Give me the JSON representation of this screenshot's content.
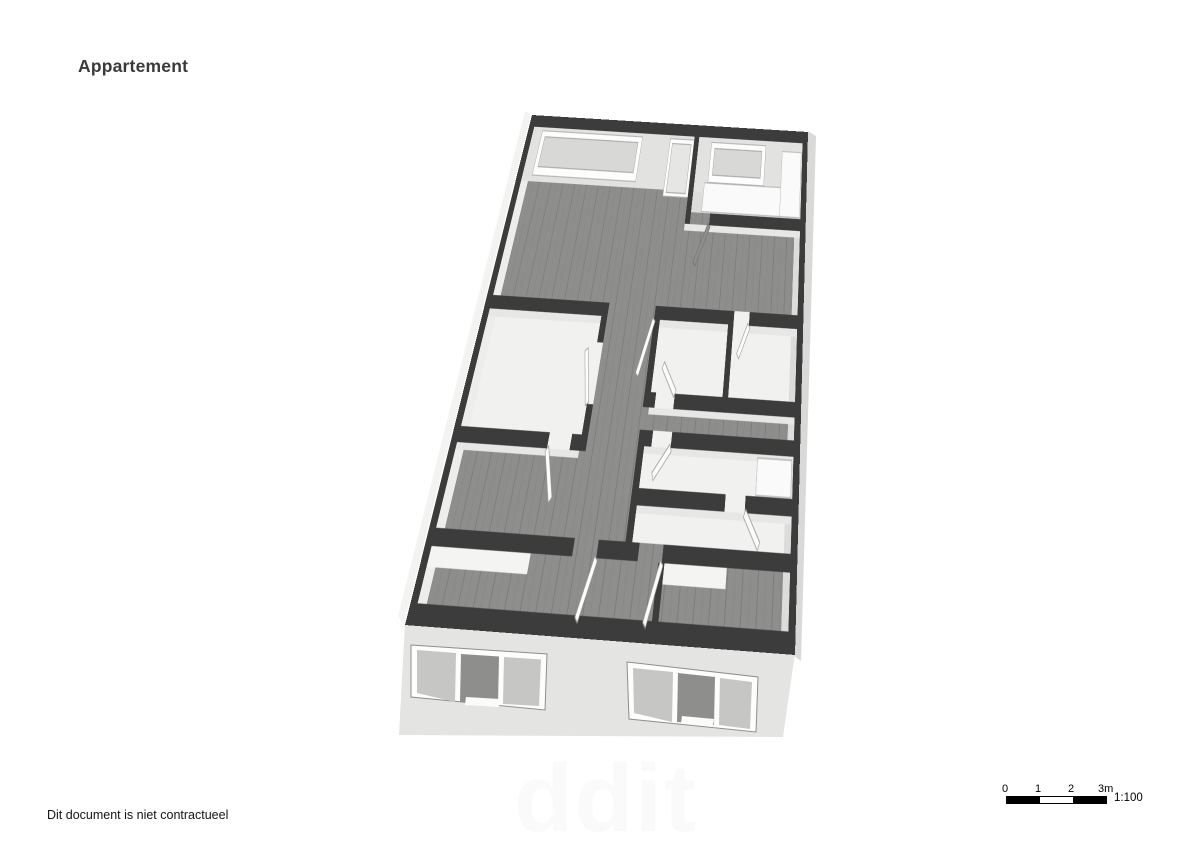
{
  "page": {
    "title": "Appartement",
    "disclaimer": "Dit document is niet contractueel",
    "watermark": "ddit"
  },
  "scale_bar": {
    "labels": [
      "0",
      "1",
      "2",
      "3m"
    ],
    "ratio": "1:100"
  },
  "palette": {
    "wall": "#3c3c3c",
    "wood_floor": "#8e8e8c",
    "wood_streak": "#7e7e7c",
    "light_floor": "#f1f1ef",
    "kitchen_floor": "#dcdcda",
    "wall_face_far": "#e2e2e0",
    "wall_face_left": "#ededeb",
    "wall_face_right": "#dcdcda",
    "room_face": "#e7e7e5",
    "facade": "#e4e4e2",
    "facade_left": "#f3f3f1",
    "facade_right": "#d9d9d7",
    "window_frame": "#fdfdfd",
    "window_glass": "#d8d8d6",
    "facade_glass": "#c6c6c4",
    "door_leaf": "#fcfcfc",
    "door_stroke": "#969694",
    "counter": "#fafafa",
    "counter_stroke": "#b2b2b0"
  }
}
